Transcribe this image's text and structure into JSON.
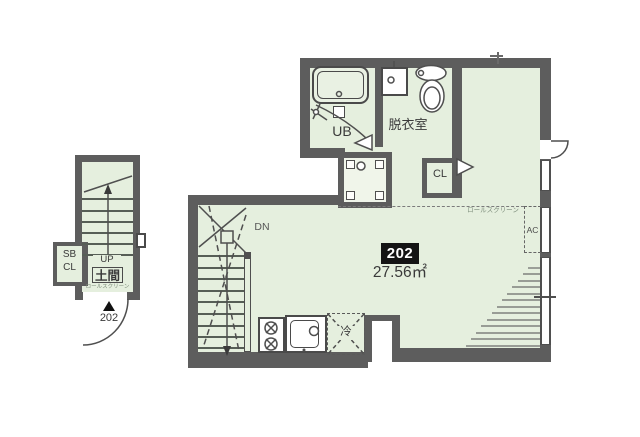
{
  "floorplan": {
    "unit": {
      "number": "202",
      "area": "27.56㎡"
    },
    "entry": {
      "storage_line1": "SB",
      "storage_line2": "CL",
      "up": "UP",
      "doma": "土間",
      "roll_screen": "ロールスクリーン",
      "door_unit": "202"
    },
    "bath": {
      "label": "UB"
    },
    "dressing": {
      "label": "脱衣室"
    },
    "closet": {
      "label": "CL"
    },
    "main": {
      "down": "DN",
      "roll_screen": "ロールスクリーン",
      "fridge": "冷",
      "ac": "AC"
    },
    "icons": {
      "bathtub-icon": "rounded-rect",
      "toilet-icon": "tank-and-bowl",
      "washbasin-icon": "square-basin",
      "washer-pan-icon": "square-pan",
      "stove-icon": "two-burners",
      "kitchen-sink-icon": "basin-faucet",
      "door-swing-icon": "quarter-arc",
      "entry-arrow-icon": "black-triangle",
      "stair-arrow-icon": "walk-line-arrow"
    },
    "colors": {
      "wall": "#5d5d5d",
      "floor": "#e5efde",
      "line": "#4f4f4f",
      "badge_bg": "#141414",
      "badge_text": "#ffffff",
      "text": "#3a3a3a"
    }
  }
}
